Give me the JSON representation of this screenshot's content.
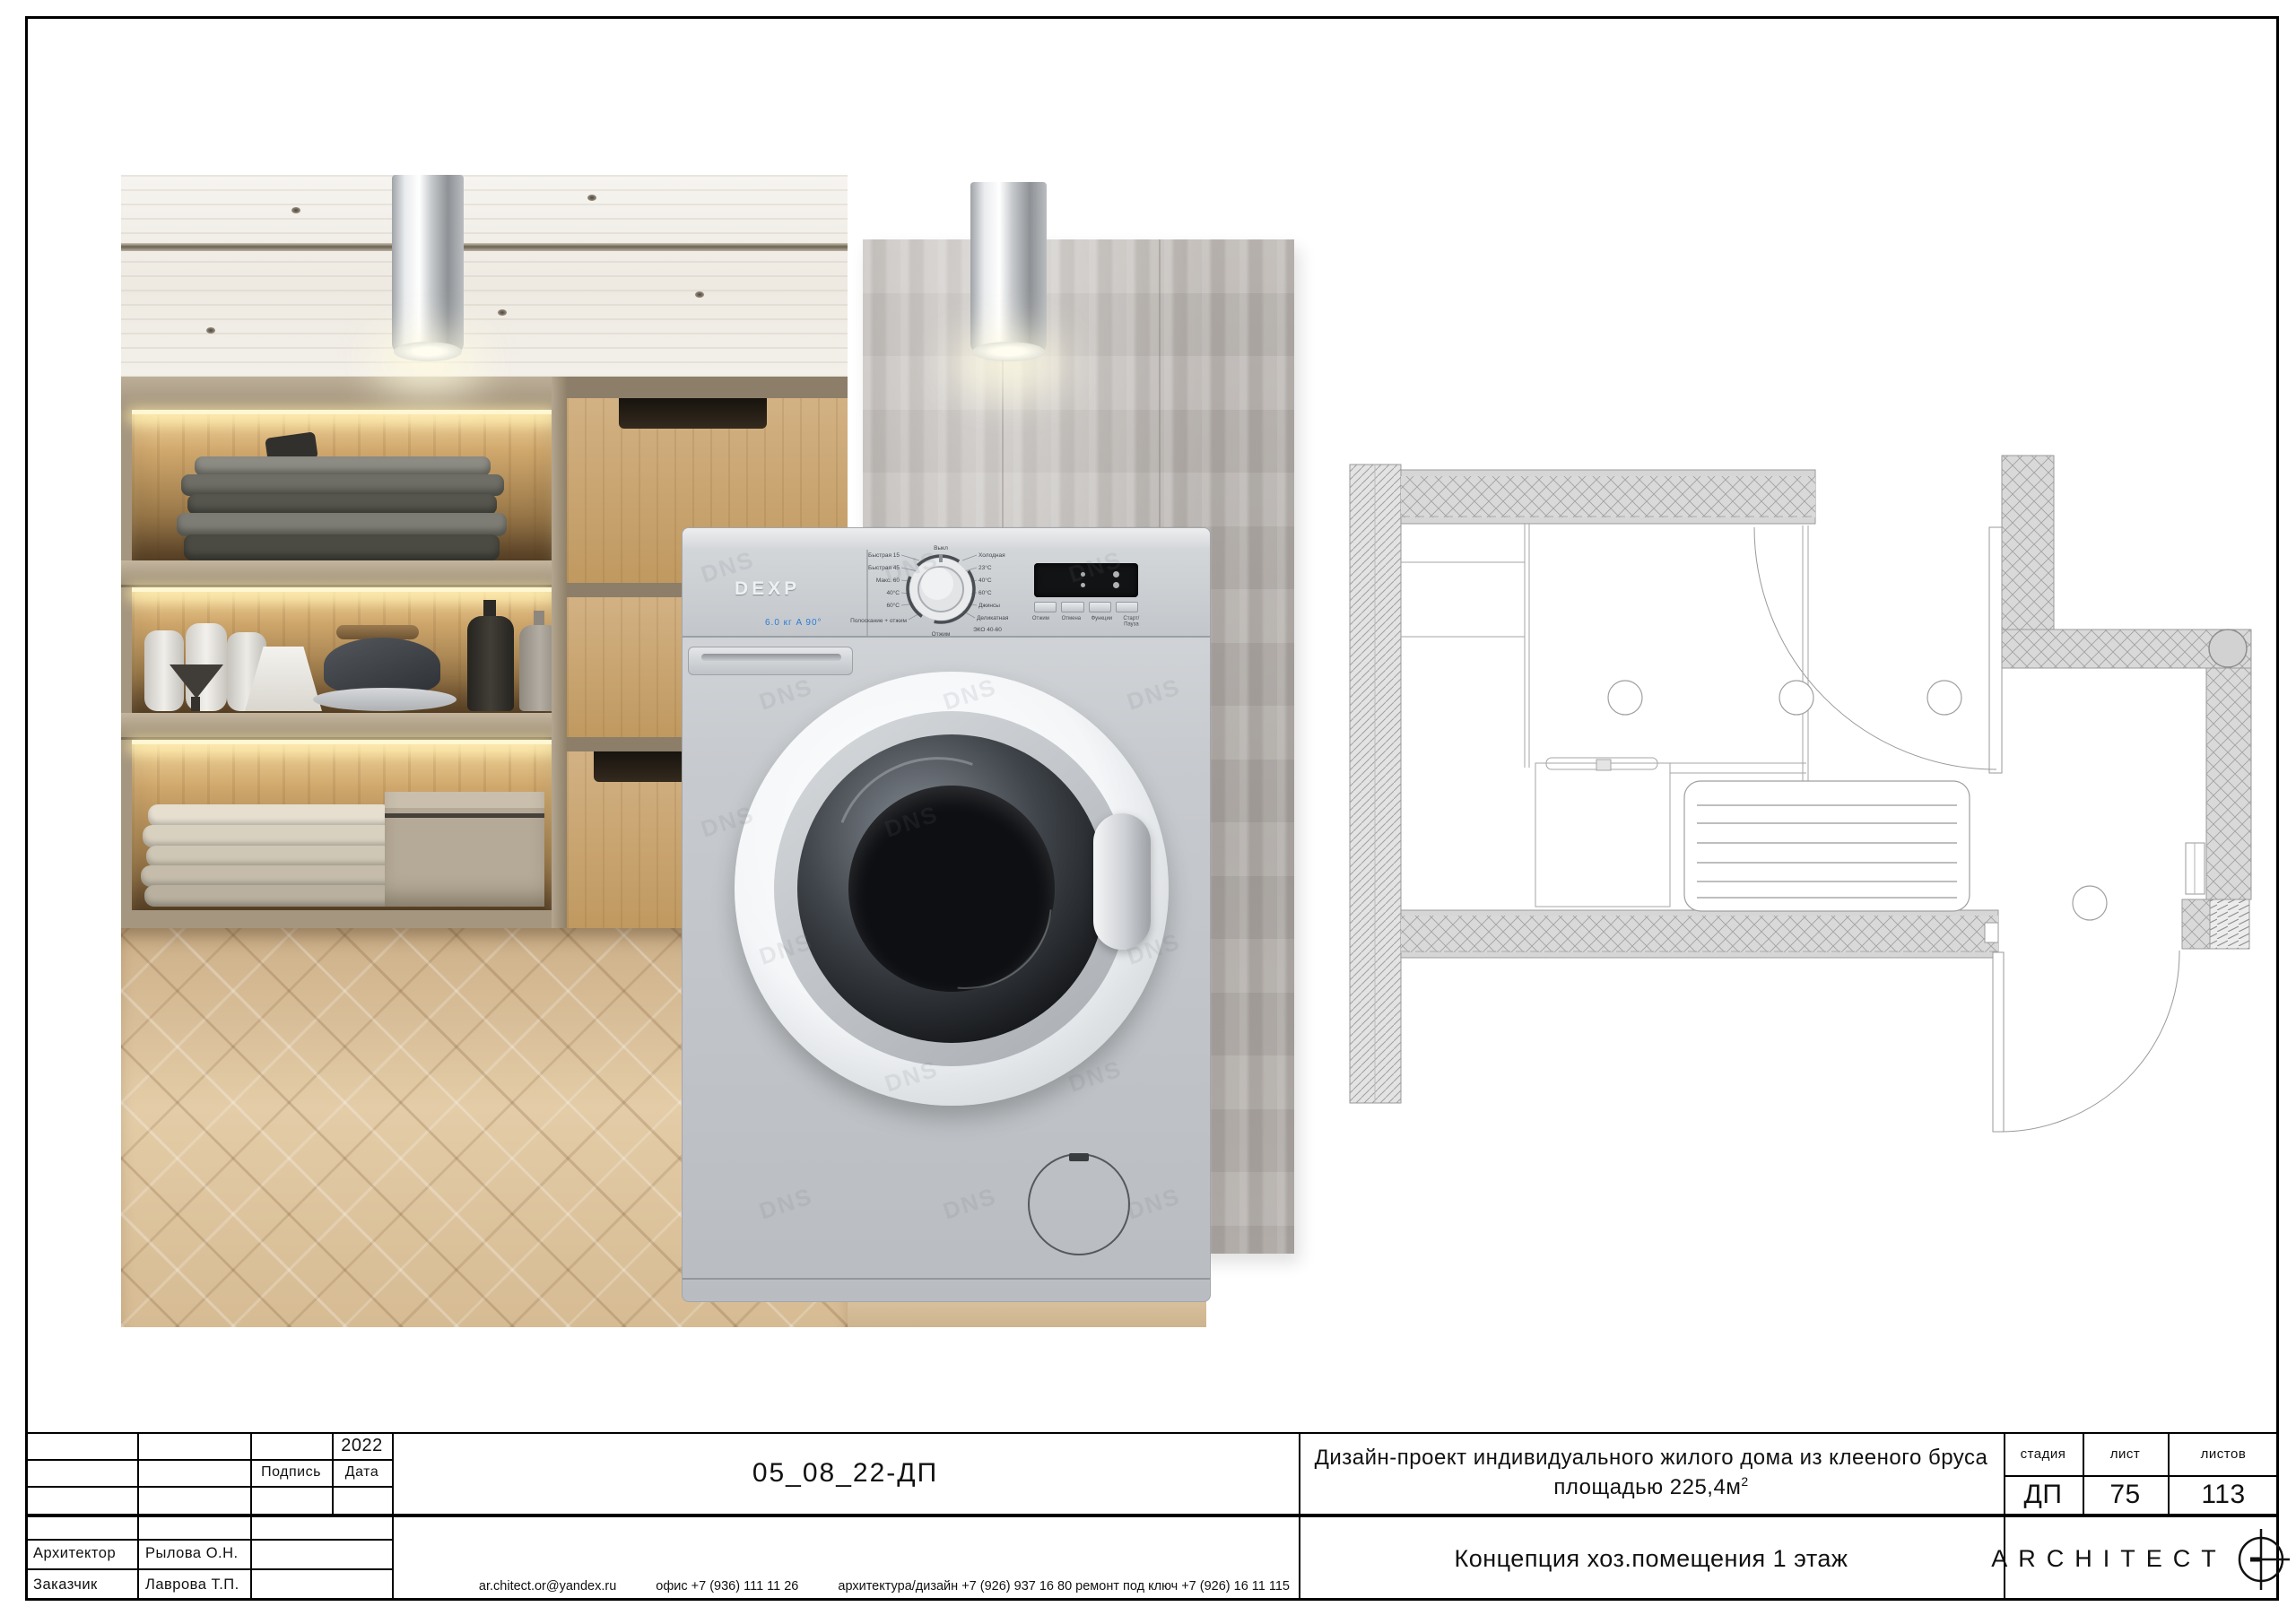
{
  "titleblock": {
    "year": "2022",
    "signature_label": "Подпись",
    "date_label": "Дата",
    "architect_label": "Архитектор",
    "architect_name": "Рылова О.Н.",
    "client_label": "Заказчик",
    "client_name": "Лаврова Т.П.",
    "doc_code": "05_08_22-ДП",
    "contacts": [
      "ar.chitect.or@yandex.ru",
      "офис +7 (936) 111 11 26",
      "архитектура/дизайн +7 (926) 937 16 80 ремонт под ключ +7 (926) 16 11 115"
    ],
    "project_title_line1": "Дизайн-проект индивидуального жилого дома из клееного бруса",
    "project_area": "площадью 225,4м",
    "project_area_sup": "2",
    "stage_label": "стадия",
    "sheet_label": "лист",
    "sheets_label": "листов",
    "stage_value": "ДП",
    "sheet_value": "75",
    "sheets_value": "113",
    "sheet_title": "Концепция хоз.помещения 1 этаж",
    "brand": "ARCHITECT"
  },
  "washer": {
    "brand": "DEXP",
    "watermark": "DNS",
    "specs": "6.0 кг    A    90°",
    "dial": {
      "top": "Выкл",
      "bottom": "Отжим",
      "left": [
        "Быстрая 15",
        "Быстрая 45",
        "Макс. 60",
        "40°C",
        "60°C",
        "Полоскание + отжим"
      ],
      "right": [
        "Холодная",
        "23°C",
        "40°C",
        "60°C",
        "Джинсы",
        "Деликатная",
        "ЭКО 40-60"
      ]
    },
    "buttons": [
      "Отжим",
      "Отмена",
      "Функции",
      "Старт/Пауза"
    ]
  }
}
